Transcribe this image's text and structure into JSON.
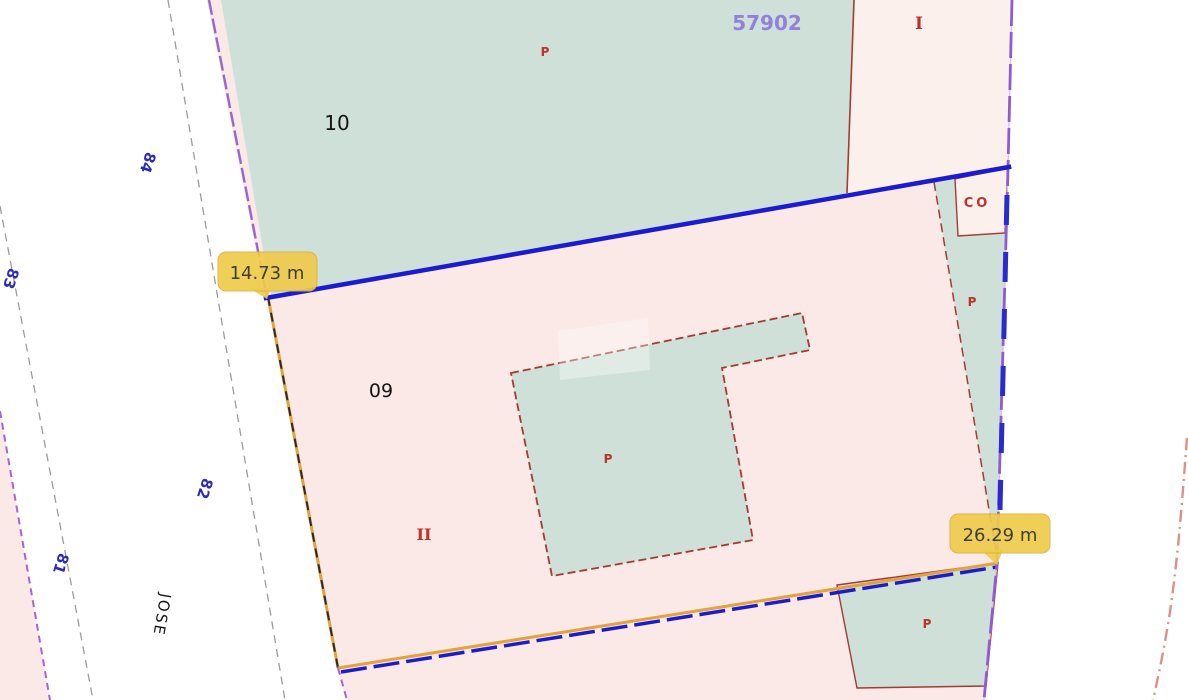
{
  "map": {
    "reference_overlay": "57902",
    "parcels": {
      "parcel_10": {
        "number": "10",
        "marker": "P"
      },
      "parcel_09": {
        "number": "09",
        "storeys": "II"
      },
      "parcel_top_right": {
        "storeys": "I"
      },
      "annex_co": {
        "label": "CO"
      },
      "right_strip": {
        "marker": "P"
      },
      "building_courtyard": {
        "marker": "P"
      },
      "bottom_patio": {
        "marker": "P"
      }
    },
    "street": {
      "name": "JOSE",
      "numbers": {
        "n84": "84",
        "n83": "83",
        "n82": "82",
        "n81": "81"
      }
    },
    "measurements": {
      "top_edge": "14.73 m",
      "right_edge": "26.29 m"
    },
    "colors": {
      "parcel_green": "#CFE0D8",
      "parcel_pink": "#FAE9E6",
      "parcel_pink_light": "#FCF0ED",
      "selection_blue": "#1B1BD1",
      "boundary_purple": "#8F5BD4",
      "edge_orange": "#E2A33C",
      "cadastral_red": "#A33B32",
      "label_red": "#C03228",
      "street_number_blue": "#2B2BB8",
      "reference_purple": "#9180DC",
      "tooltip_yellow": "#EFCB4C"
    }
  }
}
